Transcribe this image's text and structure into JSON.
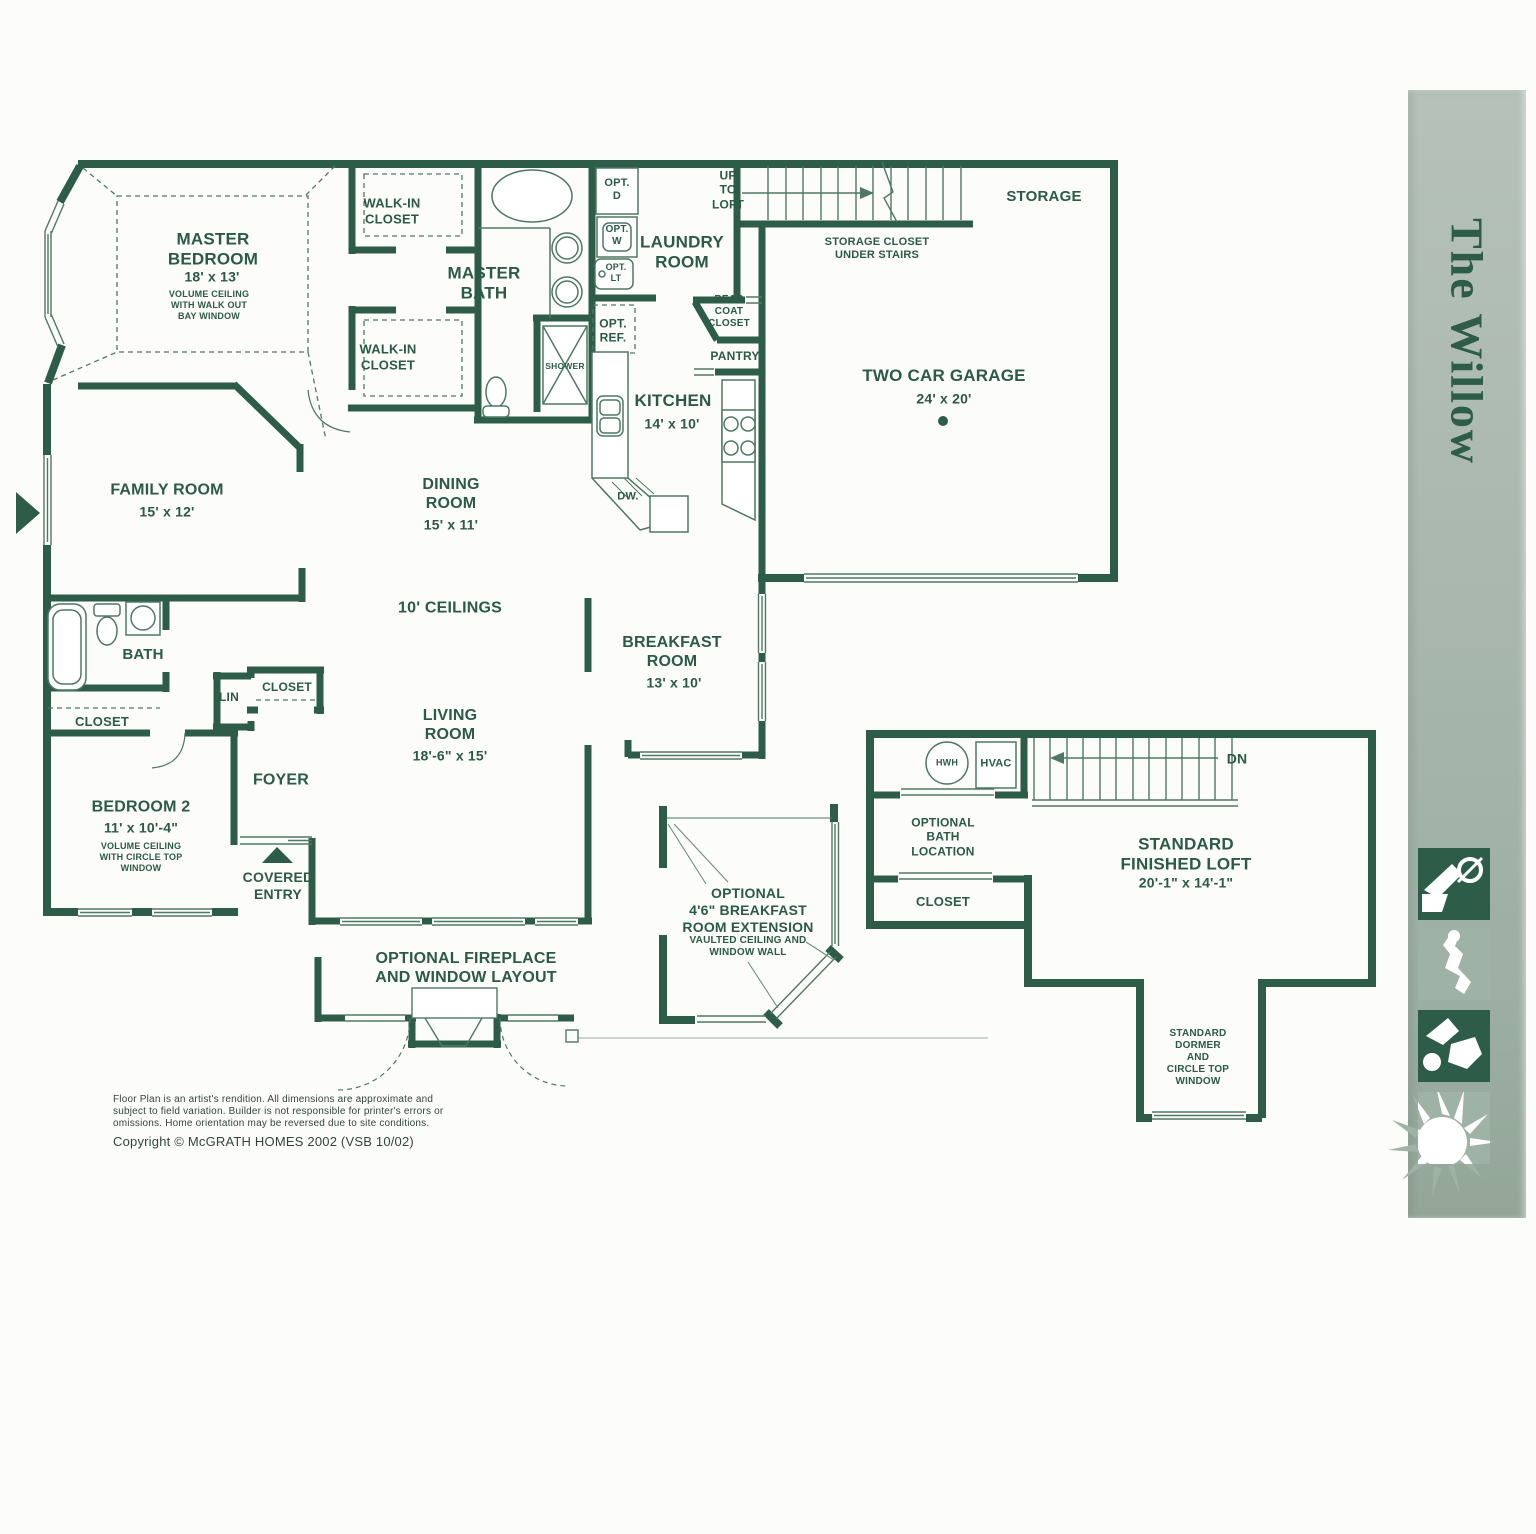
{
  "plan": {
    "master_bedroom_name": "MASTER\nBEDROOM",
    "master_bedroom_dims": "18' x 13'",
    "master_bedroom_note": "VOLUME CEILING\nWITH WALK OUT\nBAY WINDOW",
    "walk_in_closet": "WALK-IN\nCLOSET",
    "master_bath": "MASTER\nBATH",
    "shower": "SHOWER",
    "opt_d": "OPT.\nD",
    "opt_w": "OPT.\nW",
    "opt_lt": "OPT.\nLT",
    "opt_ref": "OPT.\nREF.",
    "laundry": "LAUNDRY\nROOM",
    "up_to_loft": "UP\nTO\nLOFT",
    "storage_closet": "STORAGE CLOSET\nUNDER STAIRS",
    "storage": "STORAGE",
    "rear_coat_closet": "REAR\nCOAT\nCLOSET",
    "pantry": "PANTRY",
    "kitchen_name": "KITCHEN",
    "kitchen_dims": "14' x 10'",
    "dw": "DW.",
    "garage_name": "TWO CAR GARAGE",
    "garage_dims": "24' x 20'",
    "family_name": "FAMILY ROOM",
    "family_dims": "15' x 12'",
    "dining_name": "DINING\nROOM",
    "dining_dims": "15' x 11'",
    "ceilings": "10' CEILINGS",
    "bath": "BATH",
    "closet": "CLOSET",
    "lin": "LIN",
    "bedroom2_name": "BEDROOM 2",
    "bedroom2_dims": "11' x 10'-4\"",
    "bedroom2_note": "VOLUME CEILING\nWITH CIRCLE TOP\nWINDOW",
    "foyer": "FOYER",
    "covered_entry": "COVERED\nENTRY",
    "living_name": "LIVING\nROOM",
    "living_dims": "18'-6\" x 15'",
    "breakfast_name": "BREAKFAST\nROOM",
    "breakfast_dims": "13' x 10'",
    "fireplace_option": "OPTIONAL FIREPLACE\nAND WINDOW LAYOUT",
    "breakfast_ext_name": "OPTIONAL\n4'6\" BREAKFAST\nROOM EXTENSION",
    "breakfast_ext_note": "VAULTED CEILING AND\nWINDOW WALL",
    "hwh": "HWH",
    "hvac": "HVAC",
    "dn": "DN",
    "optional_bath": "OPTIONAL\nBATH\nLOCATION",
    "loft_name": "STANDARD\nFINISHED LOFT",
    "loft_dims": "20'-1\" x 14'-1\"",
    "dormer_note": "STANDARD\nDORMER\nAND\nCIRCLE TOP\nWINDOW"
  },
  "footer": {
    "disclaimer": "Floor Plan is an artist's rendition. All dimensions are approximate and\nsubject to field variation. Builder is not responsible for printer's errors or\nomissions. Home orientation may be reversed due to site conditions.",
    "copyright": "Copyright © McGRATH HOMES 2002  (VSB 10/02)"
  },
  "sidebar": {
    "title": "The Willow",
    "icons": [
      "drafting-figure-icon",
      "dancer-figure-icon",
      "abstract-figure-icon",
      "sunburst-icon"
    ]
  },
  "colors": {
    "wall_green": "#2d5c48",
    "line_green": "#4e7863",
    "sage": "#a9b7ad"
  }
}
